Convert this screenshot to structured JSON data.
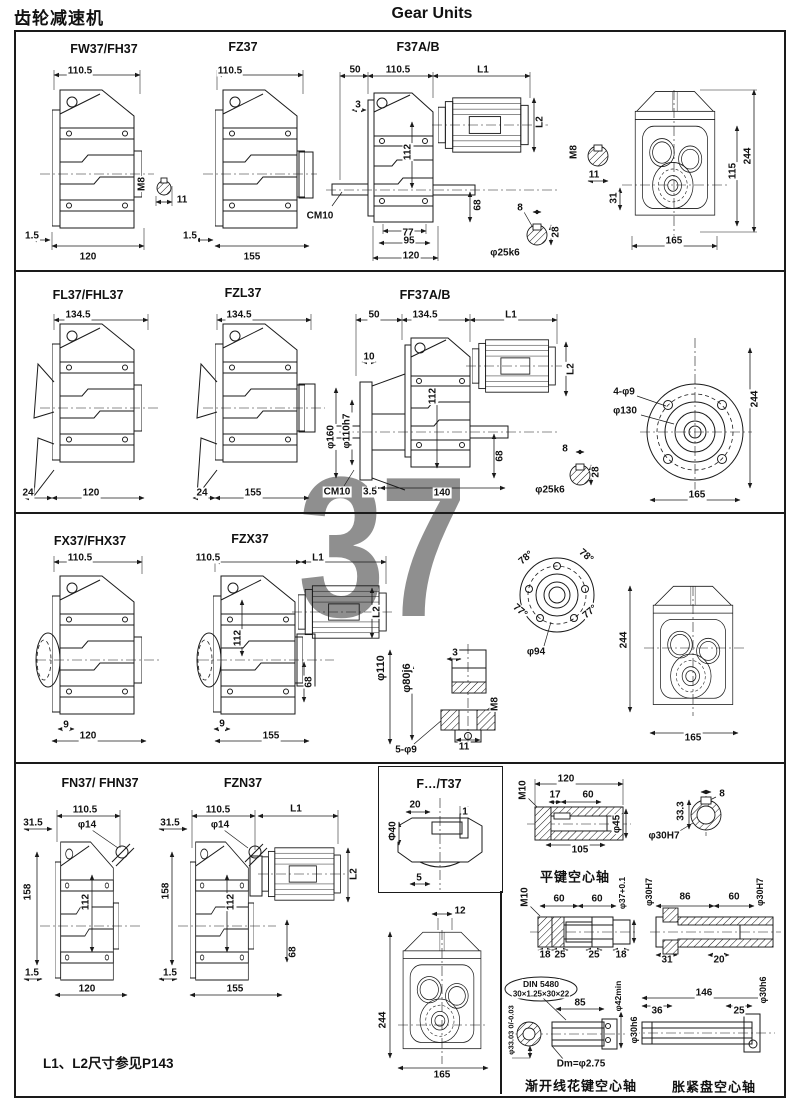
{
  "header": {
    "title_cn": "齿轮减速机",
    "title_en": "Gear Units"
  },
  "watermark": "37",
  "footnote": "L1、L2尺寸参见P143",
  "colors": {
    "line": "#1a1a1a",
    "watermark": "#8f8f8f",
    "background": "#ffffff"
  },
  "drawing_titles": [
    {
      "t": "FW37/FH37",
      "x": 104,
      "y": 49
    },
    {
      "t": "FZ37",
      "x": 243,
      "y": 47
    },
    {
      "t": "F37A/B",
      "x": 418,
      "y": 47
    },
    {
      "t": "FL37/FHL37",
      "x": 88,
      "y": 295
    },
    {
      "t": "FZL37",
      "x": 243,
      "y": 293
    },
    {
      "t": "FF37A/B",
      "x": 425,
      "y": 295
    },
    {
      "t": "FX37/FHX37",
      "x": 90,
      "y": 541
    },
    {
      "t": "FZX37",
      "x": 250,
      "y": 539
    },
    {
      "t": "FN37/ FHN37",
      "x": 100,
      "y": 783
    },
    {
      "t": "FZN37",
      "x": 243,
      "y": 783
    },
    {
      "t": "F…/T37",
      "x": 439,
      "y": 784
    },
    {
      "t": "平键空心轴",
      "x": 575,
      "y": 876,
      "cn": true
    },
    {
      "t": "渐开线花键空心轴",
      "x": 581,
      "y": 1085,
      "cn": true
    },
    {
      "t": "胀紧盘空心轴",
      "x": 714,
      "y": 1086,
      "cn": true
    }
  ],
  "dim_labels": [
    {
      "t": "110.5",
      "x": 80,
      "y": 71
    },
    {
      "t": "1.5",
      "x": 32,
      "y": 236
    },
    {
      "t": "120",
      "x": 88,
      "y": 257
    },
    {
      "t": "M8",
      "x": 142,
      "y": 184,
      "r": -90
    },
    {
      "t": "11",
      "x": 182,
      "y": 200
    },
    {
      "t": "110.5",
      "x": 230,
      "y": 71
    },
    {
      "t": "1.5",
      "x": 190,
      "y": 236
    },
    {
      "t": "155",
      "x": 252,
      "y": 257
    },
    {
      "t": "50",
      "x": 355,
      "y": 70
    },
    {
      "t": "110.5",
      "x": 398,
      "y": 70
    },
    {
      "t": "L1",
      "x": 483,
      "y": 70
    },
    {
      "t": "3",
      "x": 358,
      "y": 105
    },
    {
      "t": "L2",
      "x": 540,
      "y": 122,
      "r": -90
    },
    {
      "t": "112",
      "x": 408,
      "y": 152,
      "r": -90
    },
    {
      "t": "CM10",
      "x": 320,
      "y": 216
    },
    {
      "t": "68",
      "x": 478,
      "y": 205,
      "r": -90
    },
    {
      "t": "77",
      "x": 408,
      "y": 233
    },
    {
      "t": "95",
      "x": 409,
      "y": 241
    },
    {
      "t": "120",
      "x": 411,
      "y": 256
    },
    {
      "t": "8",
      "x": 520,
      "y": 208
    },
    {
      "t": "28",
      "x": 556,
      "y": 232,
      "r": -90
    },
    {
      "t": "φ25k6",
      "x": 505,
      "y": 253
    },
    {
      "t": "M8",
      "x": 574,
      "y": 152,
      "r": -90
    },
    {
      "t": "11",
      "x": 594,
      "y": 175
    },
    {
      "t": "31",
      "x": 614,
      "y": 198,
      "r": -90
    },
    {
      "t": "115",
      "x": 733,
      "y": 171,
      "r": -90
    },
    {
      "t": "244",
      "x": 748,
      "y": 156,
      "r": -90
    },
    {
      "t": "165",
      "x": 674,
      "y": 241
    },
    {
      "t": "134.5",
      "x": 78,
      "y": 315
    },
    {
      "t": "24",
      "x": 28,
      "y": 493
    },
    {
      "t": "120",
      "x": 91,
      "y": 493
    },
    {
      "t": "134.5",
      "x": 239,
      "y": 315
    },
    {
      "t": "24",
      "x": 202,
      "y": 493
    },
    {
      "t": "155",
      "x": 253,
      "y": 493
    },
    {
      "t": "50",
      "x": 374,
      "y": 315
    },
    {
      "t": "134.5",
      "x": 425,
      "y": 315
    },
    {
      "t": "L1",
      "x": 511,
      "y": 315
    },
    {
      "t": "10",
      "x": 369,
      "y": 357
    },
    {
      "t": "112",
      "x": 433,
      "y": 396,
      "r": -90
    },
    {
      "t": "φ110h7",
      "x": 347,
      "y": 431,
      "r": -90
    },
    {
      "t": "φ160",
      "x": 331,
      "y": 437,
      "r": -90
    },
    {
      "t": "CM10",
      "x": 337,
      "y": 492
    },
    {
      "t": "3.5",
      "x": 370,
      "y": 492
    },
    {
      "t": "140",
      "x": 442,
      "y": 493
    },
    {
      "t": "68",
      "x": 500,
      "y": 456,
      "r": -90
    },
    {
      "t": "L2",
      "x": 571,
      "y": 369,
      "r": -90
    },
    {
      "t": "8",
      "x": 565,
      "y": 449
    },
    {
      "t": "28",
      "x": 596,
      "y": 472,
      "r": -90
    },
    {
      "t": "φ25k6",
      "x": 550,
      "y": 490
    },
    {
      "t": "4-φ9",
      "x": 624,
      "y": 392
    },
    {
      "t": "φ130",
      "x": 625,
      "y": 411
    },
    {
      "t": "244",
      "x": 755,
      "y": 399,
      "r": -90
    },
    {
      "t": "165",
      "x": 697,
      "y": 495
    },
    {
      "t": "110.5",
      "x": 80,
      "y": 558
    },
    {
      "t": "9",
      "x": 66,
      "y": 725
    },
    {
      "t": "120",
      "x": 88,
      "y": 736
    },
    {
      "t": "110.5",
      "x": 208,
      "y": 558
    },
    {
      "t": "L1",
      "x": 318,
      "y": 558
    },
    {
      "t": "112",
      "x": 238,
      "y": 638,
      "r": -90
    },
    {
      "t": "68",
      "x": 309,
      "y": 682,
      "r": -90
    },
    {
      "t": "9",
      "x": 222,
      "y": 724
    },
    {
      "t": "155",
      "x": 271,
      "y": 736
    },
    {
      "t": "L2",
      "x": 377,
      "y": 612,
      "r": -90
    },
    {
      "t": "φ110",
      "x": 381,
      "y": 668,
      "r": -90,
      "s": 11
    },
    {
      "t": "φ80j6",
      "x": 407,
      "y": 678,
      "r": -90,
      "s": 11
    },
    {
      "t": "3",
      "x": 455,
      "y": 653
    },
    {
      "t": "M8",
      "x": 495,
      "y": 704,
      "r": -90
    },
    {
      "t": "11",
      "x": 464,
      "y": 747
    },
    {
      "t": "5-φ9",
      "x": 406,
      "y": 750
    },
    {
      "t": "78°",
      "x": 526,
      "y": 558,
      "r": -40
    },
    {
      "t": "78°",
      "x": 586,
      "y": 556,
      "r": 40
    },
    {
      "t": "77°",
      "x": 520,
      "y": 611,
      "r": 40
    },
    {
      "t": "77°",
      "x": 590,
      "y": 612,
      "r": -40
    },
    {
      "t": "φ94",
      "x": 536,
      "y": 652
    },
    {
      "t": "244",
      "x": 624,
      "y": 640,
      "r": -90
    },
    {
      "t": "165",
      "x": 693,
      "y": 738
    },
    {
      "t": "110.5",
      "x": 85,
      "y": 810
    },
    {
      "t": "31.5",
      "x": 33,
      "y": 823
    },
    {
      "t": "φ14",
      "x": 87,
      "y": 825
    },
    {
      "t": "158",
      "x": 28,
      "y": 892,
      "r": -90
    },
    {
      "t": "112",
      "x": 86,
      "y": 902,
      "r": -90
    },
    {
      "t": "1.5",
      "x": 32,
      "y": 973
    },
    {
      "t": "120",
      "x": 87,
      "y": 989
    },
    {
      "t": "110.5",
      "x": 218,
      "y": 810
    },
    {
      "t": "31.5",
      "x": 170,
      "y": 823
    },
    {
      "t": "φ14",
      "x": 220,
      "y": 825
    },
    {
      "t": "L1",
      "x": 296,
      "y": 809
    },
    {
      "t": "158",
      "x": 166,
      "y": 891,
      "r": -90
    },
    {
      "t": "112",
      "x": 231,
      "y": 902,
      "r": -90
    },
    {
      "t": "L2",
      "x": 354,
      "y": 874,
      "r": -90
    },
    {
      "t": "68",
      "x": 293,
      "y": 952,
      "r": -90
    },
    {
      "t": "1.5",
      "x": 170,
      "y": 973
    },
    {
      "t": "155",
      "x": 235,
      "y": 989
    },
    {
      "t": "20",
      "x": 415,
      "y": 805
    },
    {
      "t": "1",
      "x": 465,
      "y": 812
    },
    {
      "t": "Φ40",
      "x": 393,
      "y": 831,
      "r": -90
    },
    {
      "t": "5",
      "x": 419,
      "y": 878
    },
    {
      "t": "12",
      "x": 460,
      "y": 911
    },
    {
      "t": "244",
      "x": 383,
      "y": 1020,
      "r": -90
    },
    {
      "t": "165",
      "x": 442,
      "y": 1075
    },
    {
      "t": "120",
      "x": 566,
      "y": 779
    },
    {
      "t": "17",
      "x": 555,
      "y": 795
    },
    {
      "t": "60",
      "x": 588,
      "y": 795
    },
    {
      "t": "M10",
      "x": 523,
      "y": 790,
      "r": -90
    },
    {
      "t": "φ45",
      "x": 617,
      "y": 824,
      "r": -90
    },
    {
      "t": "105",
      "x": 580,
      "y": 850
    },
    {
      "t": "8",
      "x": 722,
      "y": 794
    },
    {
      "t": "33.3",
      "x": 681,
      "y": 811,
      "r": -90
    },
    {
      "t": "φ30H7",
      "x": 664,
      "y": 836
    },
    {
      "t": "M10",
      "x": 525,
      "y": 897,
      "r": -90
    },
    {
      "t": "60",
      "x": 559,
      "y": 899
    },
    {
      "t": "60",
      "x": 597,
      "y": 899
    },
    {
      "t": "φ37+0.1",
      "x": 622,
      "y": 893,
      "r": -90,
      "s": 8.5
    },
    {
      "t": "18",
      "x": 545,
      "y": 955
    },
    {
      "t": "25",
      "x": 560,
      "y": 955
    },
    {
      "t": "25",
      "x": 594,
      "y": 955
    },
    {
      "t": "18",
      "x": 621,
      "y": 955
    },
    {
      "t": "φ30H7",
      "x": 649,
      "y": 892,
      "r": -90,
      "s": 9
    },
    {
      "t": "86",
      "x": 685,
      "y": 897
    },
    {
      "t": "60",
      "x": 734,
      "y": 897
    },
    {
      "t": "φ30H7",
      "x": 760,
      "y": 892,
      "r": -90,
      "s": 9
    },
    {
      "t": "31",
      "x": 667,
      "y": 960
    },
    {
      "t": "20",
      "x": 719,
      "y": 960
    },
    {
      "t": "DIN 5480",
      "x": 541,
      "y": 984,
      "s": 8.5
    },
    {
      "t": "30×1.25×30×22",
      "x": 541,
      "y": 994,
      "s": 8
    },
    {
      "t": "85",
      "x": 580,
      "y": 1003
    },
    {
      "t": "φ42min",
      "x": 618,
      "y": 996,
      "r": -90,
      "s": 8.5
    },
    {
      "t": "φ33.03 0/-0.03",
      "x": 511,
      "y": 1030,
      "r": -90,
      "s": 7.5
    },
    {
      "t": "Dm=φ2.75",
      "x": 581,
      "y": 1064
    },
    {
      "t": "146",
      "x": 704,
      "y": 993
    },
    {
      "t": "36",
      "x": 657,
      "y": 1011
    },
    {
      "t": "25",
      "x": 739,
      "y": 1011
    },
    {
      "t": "φ30h6",
      "x": 634,
      "y": 1030,
      "r": -90,
      "s": 9
    },
    {
      "t": "φ30h6",
      "x": 763,
      "y": 990,
      "r": -90,
      "s": 9
    }
  ]
}
